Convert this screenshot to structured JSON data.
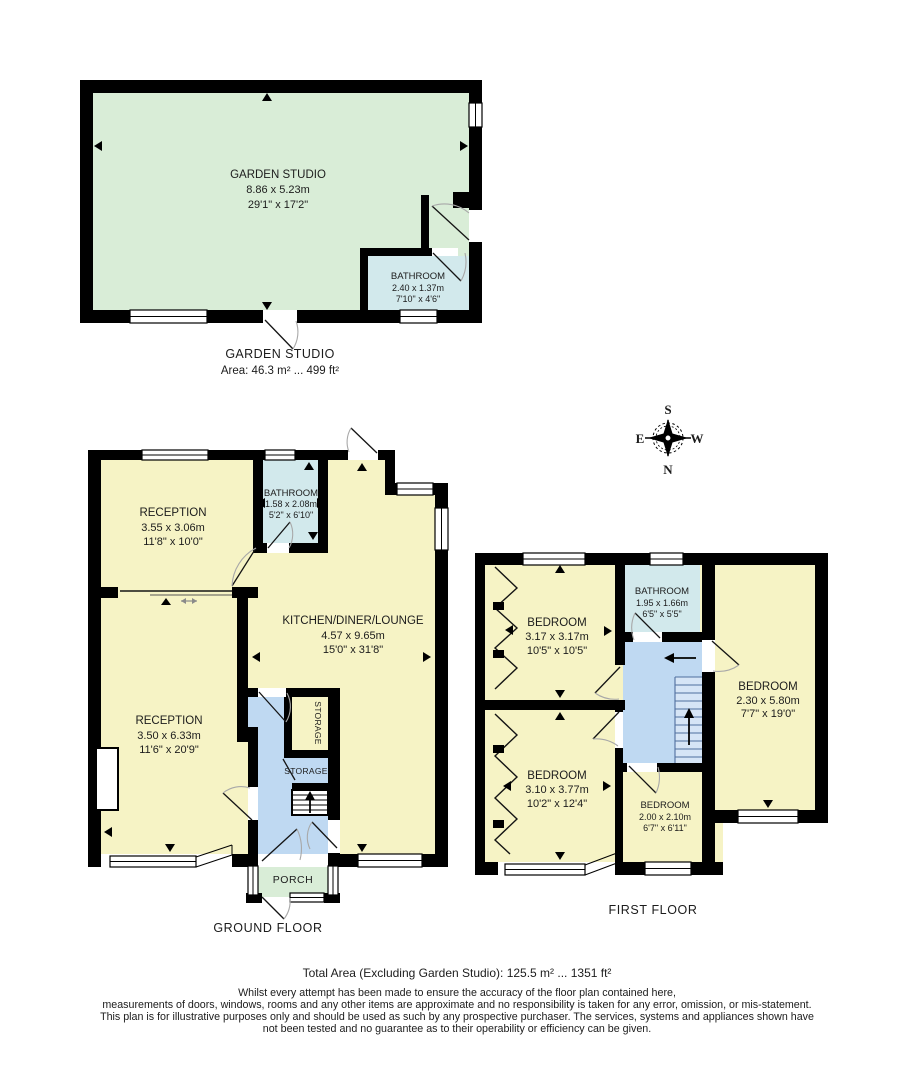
{
  "garden_studio": {
    "room": {
      "name": "GARDEN STUDIO",
      "metric": "8.86 x 5.23m",
      "imperial": "29'1\" x 17'2\""
    },
    "bathroom": {
      "name": "BATHROOM",
      "metric": "2.40 x 1.37m",
      "imperial": "7'10\" x 4'6\""
    },
    "caption_title": "GARDEN STUDIO",
    "caption_area": "Area: 46.3 m² ... 499 ft²"
  },
  "compass": {
    "n": "N",
    "s": "S",
    "e": "E",
    "w": "W"
  },
  "ground_floor": {
    "label": "GROUND FLOOR",
    "reception1": {
      "name": "RECEPTION",
      "metric": "3.55 x 3.06m",
      "imperial": "11'8\" x 10'0\""
    },
    "bathroom": {
      "name": "BATHROOM",
      "metric": "1.58 x 2.08m",
      "imperial": "5'2\" x 6'10\""
    },
    "kitchen": {
      "name": "KITCHEN/DINER/LOUNGE",
      "metric": "4.57 x 9.65m",
      "imperial": "15'0\" x 31'8\""
    },
    "reception2": {
      "name": "RECEPTION",
      "metric": "3.50 x 6.33m",
      "imperial": "11'6\" x 20'9\""
    },
    "storage1": "STORAGE",
    "storage2": "STORAGE",
    "porch": "PORCH"
  },
  "first_floor": {
    "label": "FIRST FLOOR",
    "bedroom1": {
      "name": "BEDROOM",
      "metric": "3.17 x 3.17m",
      "imperial": "10'5\" x 10'5\""
    },
    "bathroom": {
      "name": "BATHROOM",
      "metric": "1.95 x 1.66m",
      "imperial": "6'5\" x 5'5\""
    },
    "bedroom2": {
      "name": "BEDROOM",
      "metric": "2.30 x 5.80m",
      "imperial": "7'7\" x 19'0\""
    },
    "bedroom3": {
      "name": "BEDROOM",
      "metric": "3.10 x 3.77m",
      "imperial": "10'2\" x 12'4\""
    },
    "bedroom4": {
      "name": "BEDROOM",
      "metric": "2.00 x 2.10m",
      "imperial": "6'7\" x 6'11\""
    }
  },
  "footer": {
    "total_area": "Total Area (Excluding Garden Studio): 125.5 m² ... 1351 ft²",
    "disclaimer": [
      "Whilst every attempt has been made to ensure the accuracy of the floor plan contained here,",
      "measurements of doors, windows, rooms and any other items are approximate and no responsibility is taken for any error, omission, or mis-statement.",
      "This plan is for illustrative purposes only and should be used as such by any prospective purchaser. The services, systems and appliances shown have",
      "not been tested and no guarantee as to their operability or efficiency can be given."
    ]
  },
  "colors": {
    "room_yellow": "#F6F3C5",
    "studio_green": "#D9EDD7",
    "bathroom_cyan": "#D2E9EC",
    "hall_blue": "#BFD9F2",
    "wall_black": "#000000"
  }
}
